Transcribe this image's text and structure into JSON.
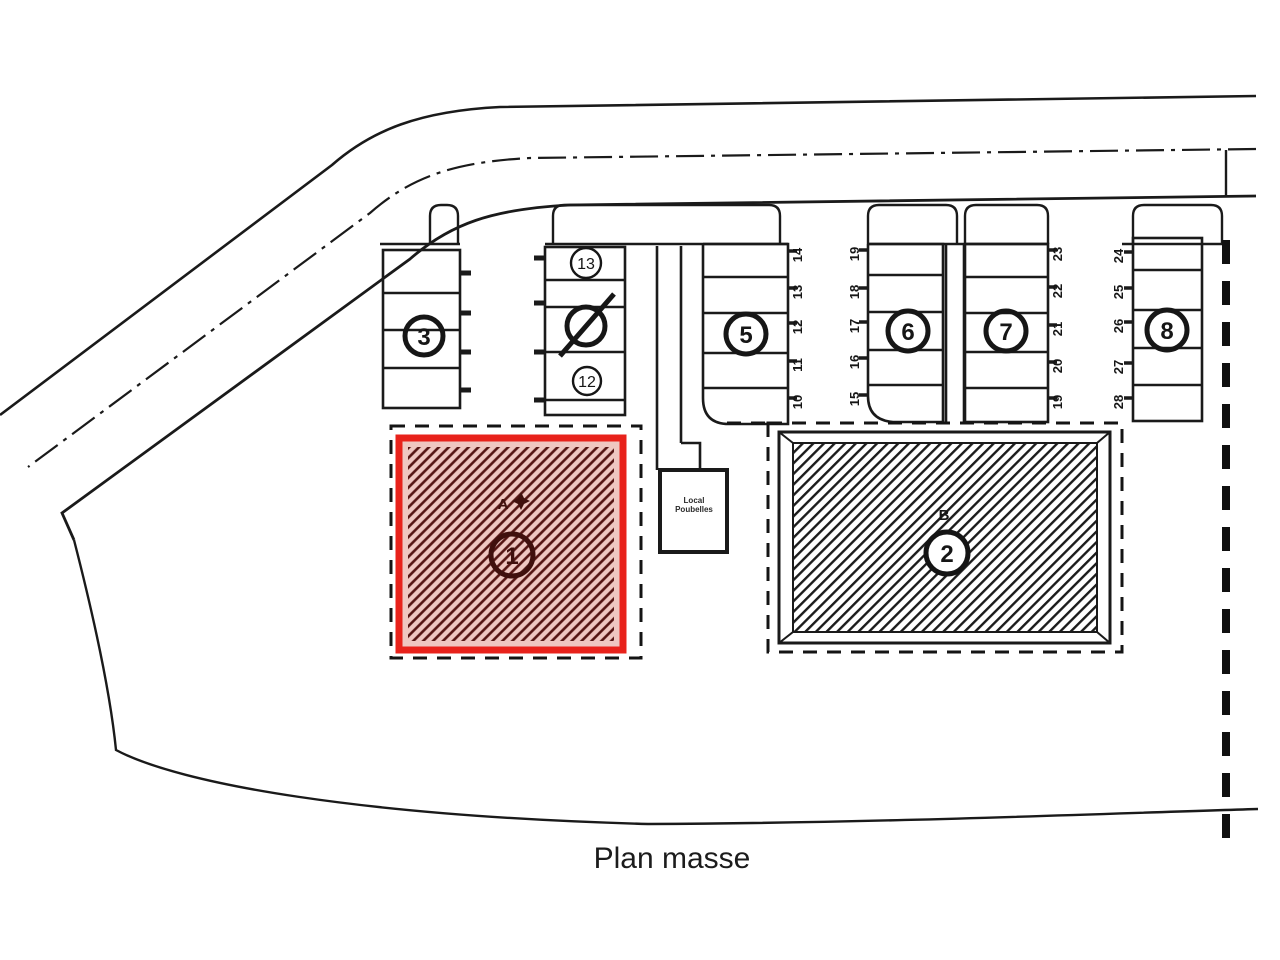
{
  "title": "Plan masse",
  "colors": {
    "line": "#1a1a1a",
    "highlight_red": "#e8221b",
    "building_a_fill": "#efc7c1",
    "building_a_hatch": "#541412",
    "building_b_hatch": "#1b1b1b"
  },
  "plan": {
    "circled_numbers": {
      "c3": "3",
      "c13": "13",
      "c12": "12",
      "c5": "5",
      "c6": "6",
      "c7": "7",
      "c8": "8"
    },
    "building_a": {
      "label": "A",
      "circle": "1"
    },
    "building_b": {
      "label": "B",
      "circle": "2"
    },
    "bin_store": {
      "line1": "Local",
      "line2": "Poubelles"
    },
    "space_numbers": {
      "col1": [
        "14",
        "13",
        "12",
        "11",
        "10"
      ],
      "col2": [
        "19",
        "18",
        "17",
        "16",
        "15"
      ],
      "col3": [
        "23",
        "22",
        "21",
        "20",
        "19"
      ],
      "col4": [
        "24",
        "25",
        "26",
        "27",
        "28"
      ]
    }
  }
}
